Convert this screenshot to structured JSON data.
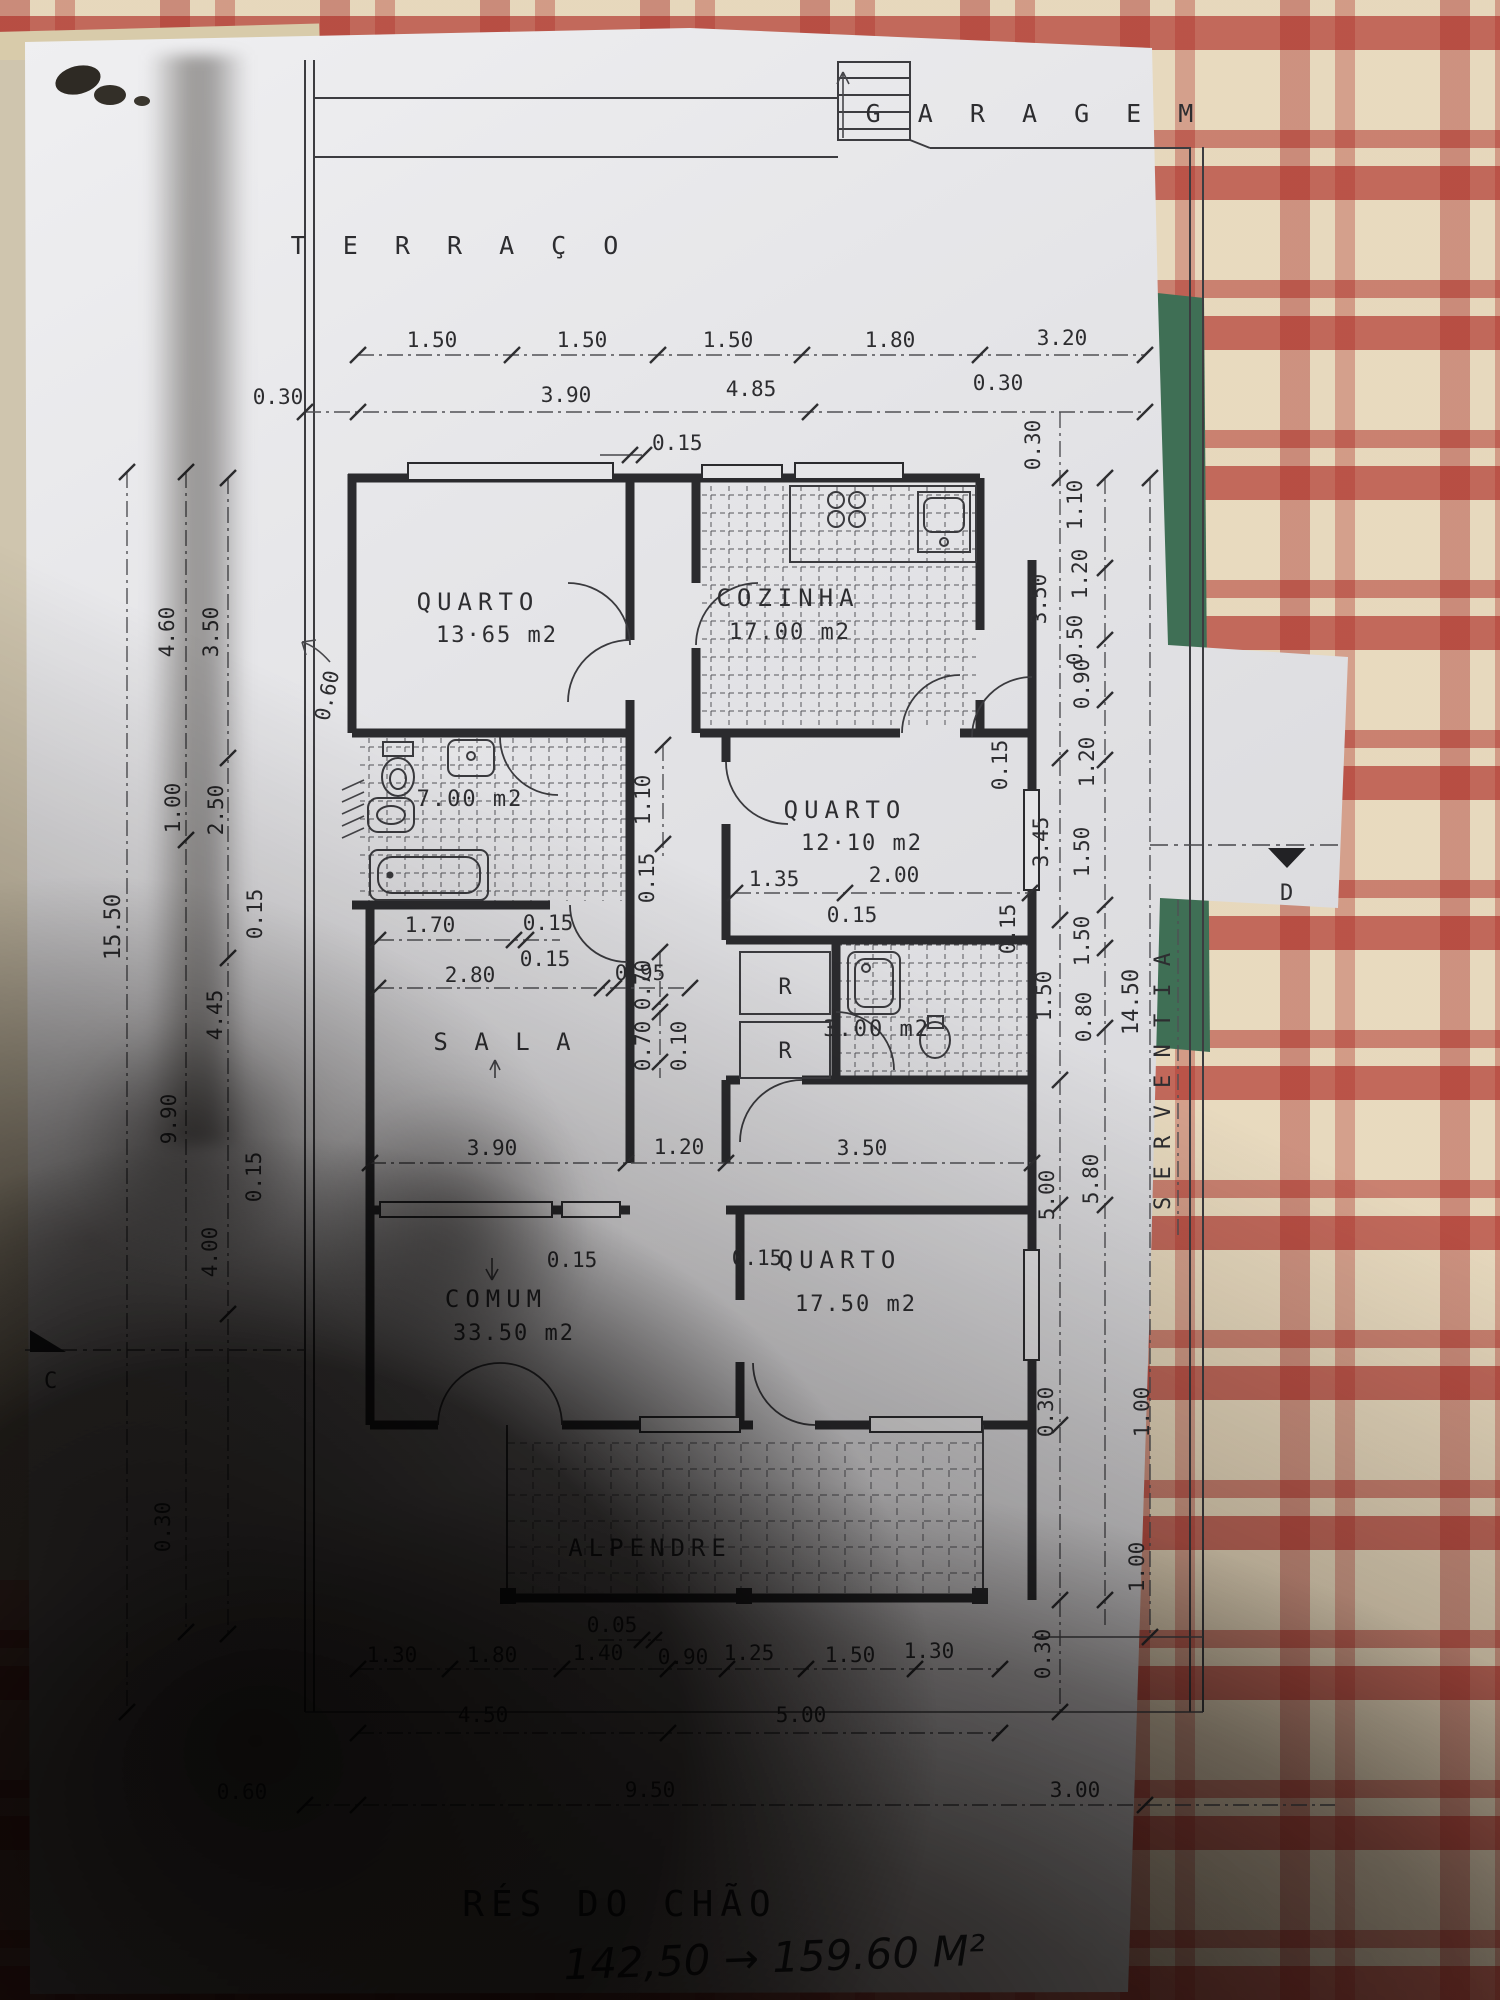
{
  "site": {
    "garagem": "G A R A G E M",
    "terraco": "T E R R A Ç O",
    "serventia": "S E R V E N T I A"
  },
  "title": {
    "floor": "RÉS  DO CHÃO",
    "note": "142,50 → 159.60 M²"
  },
  "markers": {
    "c": "C",
    "d": "D"
  },
  "rooms": {
    "quarto1_name": "QUARTO",
    "quarto1_area": "13·65 m2",
    "cozinha_name": "COZINHA",
    "cozinha_area": "17.00 m2",
    "banho_area": "7.00 m2",
    "quarto2_name": "QUARTO",
    "quarto2_area": "12·10 m2",
    "sala_name": "S A L A",
    "wc_area": "3.00 m2",
    "comum_name": "COMUM",
    "comum_area": "33.50 m2",
    "quarto3_name": "QUARTO",
    "quarto3_area": "17.50 m2",
    "alpendre_name": "ALPENDRE",
    "r1": "R",
    "r2": "R"
  },
  "dims": {
    "top1": [
      "1.50",
      "1.50",
      "1.50",
      "1.80",
      "3.20"
    ],
    "top2": [
      "0.30",
      "3.90",
      "4.85",
      "0.30"
    ],
    "top_wall": "0.15",
    "left": [
      "4.60",
      "3.50",
      "1.00",
      "2.50",
      "0.15",
      "15.50",
      "4.45",
      "9.90",
      "0.15",
      "4.00",
      "0.30"
    ],
    "recess": "0.60",
    "hall_w": "1.10",
    "hall_wall": "0.15",
    "q2": [
      "1.35",
      "2.00",
      "0.15"
    ],
    "sala_top": [
      "1.70",
      "0.15",
      "0.15",
      "2.80",
      "0.95"
    ],
    "closet": [
      "0.70",
      "0.70",
      "0.10"
    ],
    "mid": [
      "3.90",
      "1.20",
      "3.50"
    ],
    "mid2": [
      "0.15",
      "0.15"
    ],
    "right_inner": [
      "0.30",
      "3.50",
      "0.15",
      "3.45",
      "0.15",
      "1.50",
      "5.00",
      "0.30",
      "0.30"
    ],
    "right_outer": [
      "1.10",
      "1.20",
      "0.50",
      "0.90",
      "1.20",
      "1.50",
      "1.50",
      "0.80",
      "5.80",
      "1.00",
      "1.00"
    ],
    "right_far": "14.50",
    "bottom0": "0.05",
    "bottom1": [
      "1.30",
      "1.80",
      "1.40",
      "0.90",
      "1.25",
      "1.50",
      "1.30"
    ],
    "bottom2": [
      "4.50",
      "5.00"
    ],
    "bottom3": [
      "0.60",
      "9.50",
      "3.00"
    ]
  }
}
